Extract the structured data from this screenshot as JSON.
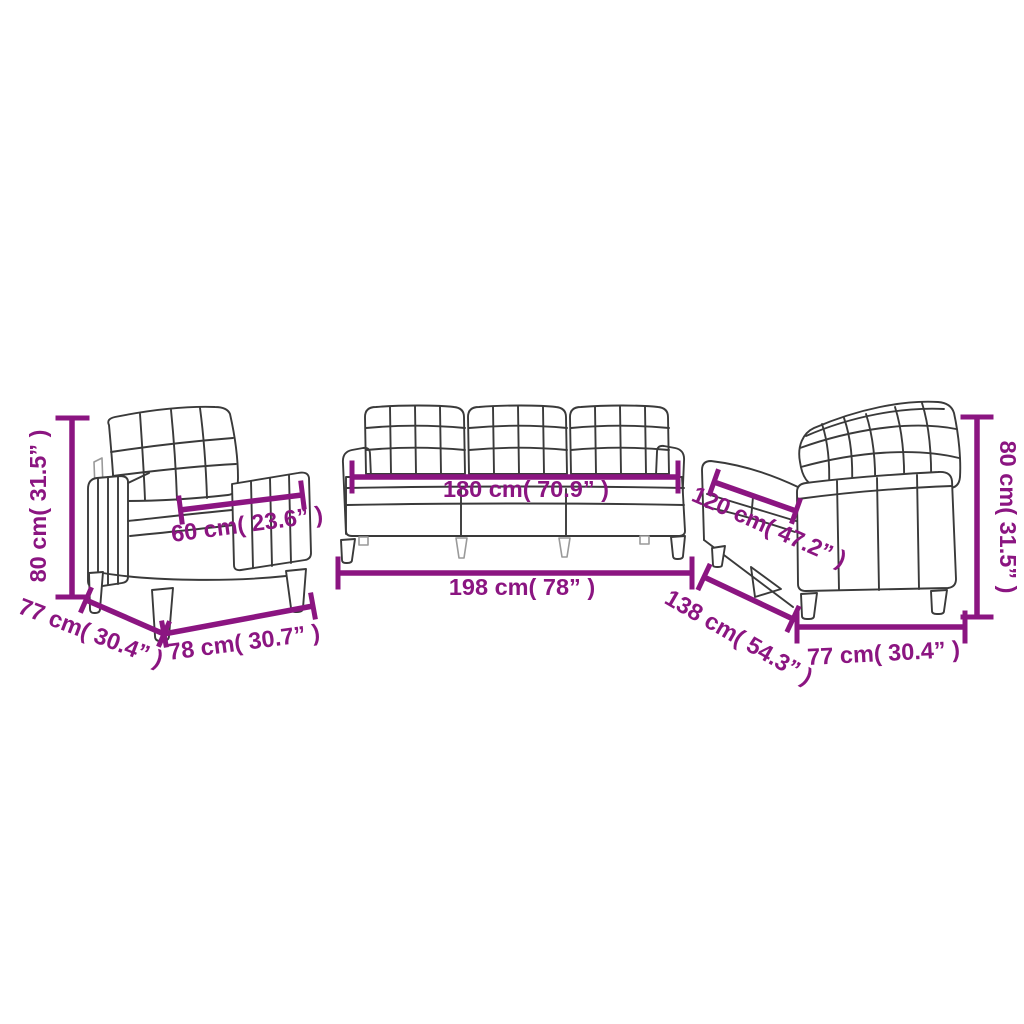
{
  "diagram": {
    "background_color": "#ffffff",
    "accent_color": "#8b1581",
    "line_art_color": "#3a3a3a",
    "pieces": [
      {
        "id": "armchair",
        "labels": {
          "height": "80 cm( 31.5” )",
          "seat_width": "60 cm( 23.6” )",
          "depth": "77 cm( 30.4” )",
          "width": "78 cm( 30.7” )"
        }
      },
      {
        "id": "three-seater-sofa",
        "labels": {
          "seat_width": "180 cm( 70.9” )",
          "width": "198 cm( 78” )"
        }
      },
      {
        "id": "two-seater-sofa",
        "labels": {
          "seat_width": "120 cm( 47.2” )",
          "width": "138 cm( 54.3” )",
          "depth": "77 cm( 30.4” )",
          "height": "80 cm( 31.5” )"
        }
      }
    ]
  }
}
